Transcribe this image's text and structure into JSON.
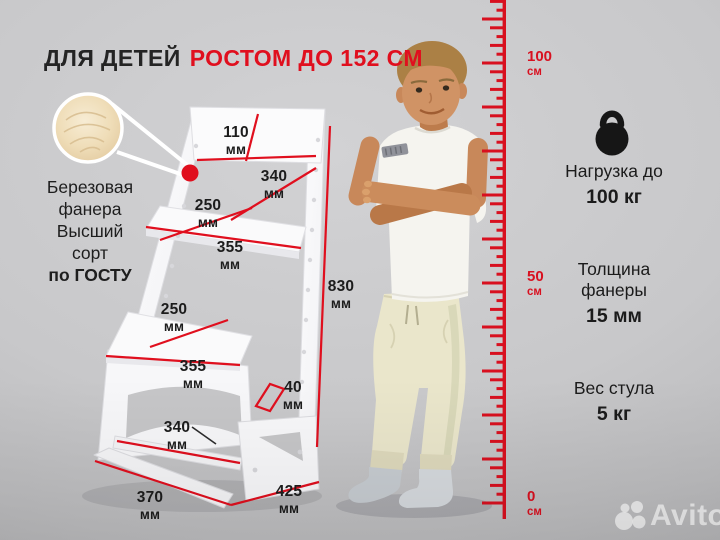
{
  "title": {
    "prefix": "ДЛЯ ДЕТЕЙ",
    "highlight": "РОСТОМ ДО 152 СМ"
  },
  "material": {
    "lines": [
      "Березовая",
      "фанера",
      "Высший",
      "сорт"
    ],
    "bold_line": "по ГОСТУ"
  },
  "measurements": {
    "backrest_height": {
      "value": "110",
      "unit": "мм"
    },
    "backrest_width": {
      "value": "340",
      "unit": "мм"
    },
    "seat_depth": {
      "value": "250",
      "unit": "мм"
    },
    "seat_width": {
      "value": "355",
      "unit": "мм"
    },
    "footrest_depth": {
      "value": "250",
      "unit": "мм"
    },
    "footrest_width": {
      "value": "355",
      "unit": "мм"
    },
    "rail_width": {
      "value": "40",
      "unit": "мм"
    },
    "chair_height": {
      "value": "830",
      "unit": "мм"
    },
    "crossbar_width": {
      "value": "340",
      "unit": "мм"
    },
    "base_depth": {
      "value": "370",
      "unit": "мм"
    },
    "base_width": {
      "value": "425",
      "unit": "мм"
    }
  },
  "ruler": {
    "top_label": {
      "value": "100",
      "unit": "см"
    },
    "mid_label": {
      "value": "50",
      "unit": "см"
    },
    "bottom_label": {
      "value": "0",
      "unit": "см"
    }
  },
  "specs": {
    "load": {
      "label": "Нагрузка до",
      "value": "100 кг"
    },
    "thickness": {
      "label_line1": "Толщина",
      "label_line2": "фанеры",
      "value": "15 мм"
    },
    "weight": {
      "label": "Вес стула",
      "value": "5 кг"
    }
  },
  "watermark": {
    "brand": "Avito"
  },
  "colors": {
    "accent": "#e00f1e",
    "ruler_red": "#d8101f",
    "text_dark": "#1c1c1c",
    "chair_white": "#fafafb",
    "wood": "#eedcb6"
  }
}
